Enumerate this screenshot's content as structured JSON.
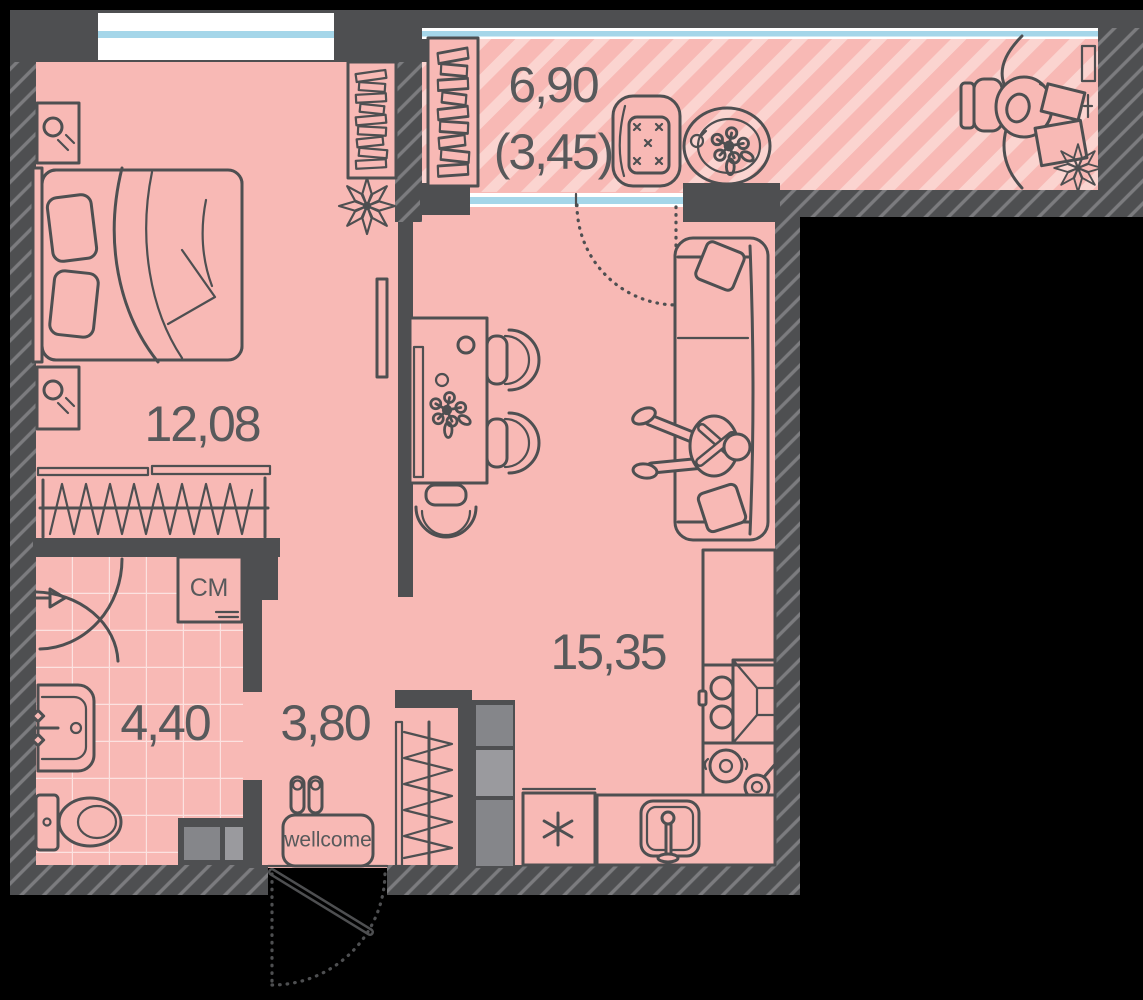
{
  "plan": {
    "type": "apartment floor plan",
    "rooms": {
      "bedroom": {
        "name": "bedroom",
        "area": "12,08"
      },
      "living_kitchen": {
        "name": "living room / kitchen",
        "area": "15,35"
      },
      "hallway": {
        "name": "hallway",
        "area": "3,80"
      },
      "bathroom": {
        "name": "bathroom",
        "area": "4,40"
      },
      "balcony": {
        "name": "balcony",
        "area_total": "6,90",
        "area_coefficient": "(3,45)"
      }
    },
    "annotations": {
      "washing_machine": "СМ",
      "doormat": "wellcome"
    }
  },
  "colors": {
    "background": "#000000",
    "wall": "#4E4F51",
    "wall_hatch": "#7C7C7F",
    "floor": "#F8B9B5",
    "balcony_stripe": "#FBD4D0",
    "tile_line": "#FCE2E0",
    "window_glass": "#A5D6E9",
    "window_frame": "#FFFFFF",
    "line": "#4E4F51",
    "text": "#58595B",
    "cabinet_gray": "#85868A",
    "cabinet_gray_light": "#9A9A9E"
  }
}
